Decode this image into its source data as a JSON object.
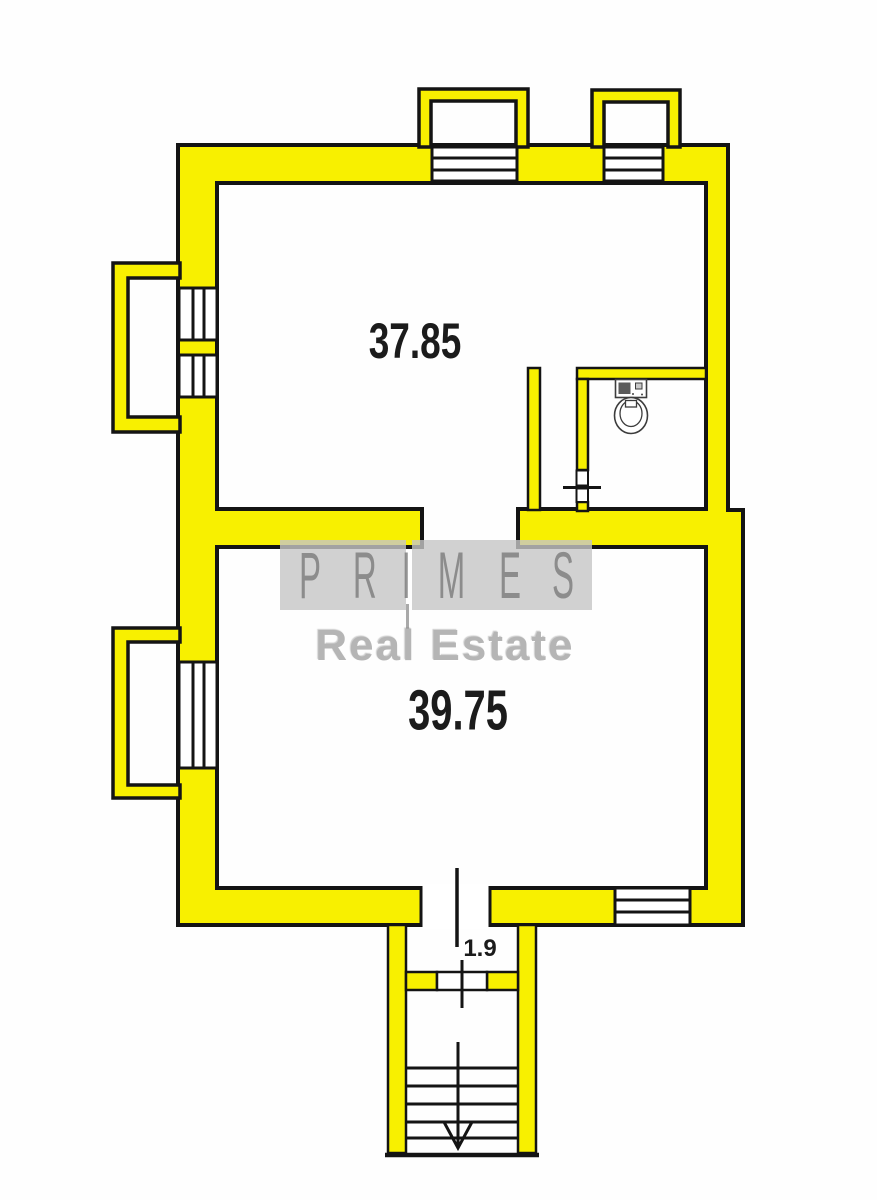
{
  "canvas": {
    "width": 877,
    "height": 1200
  },
  "colors": {
    "wall_fill": "#F8F000",
    "outline": "#141414",
    "room_label": "#1b1b1b",
    "watermark_gray": "#c5c5c5"
  },
  "rooms": {
    "upper": {
      "area": "37.85"
    },
    "lower": {
      "area": "39.75"
    }
  },
  "stairs": {
    "width_label": "1.9"
  },
  "watermark": {
    "brand_letters": [
      "P",
      "R",
      "I",
      "M",
      "E",
      "S"
    ],
    "subtitle": "Real Estate"
  },
  "icons": {
    "toilet": "toilet-plan-symbol",
    "stairs_direction": "down-arrow"
  }
}
